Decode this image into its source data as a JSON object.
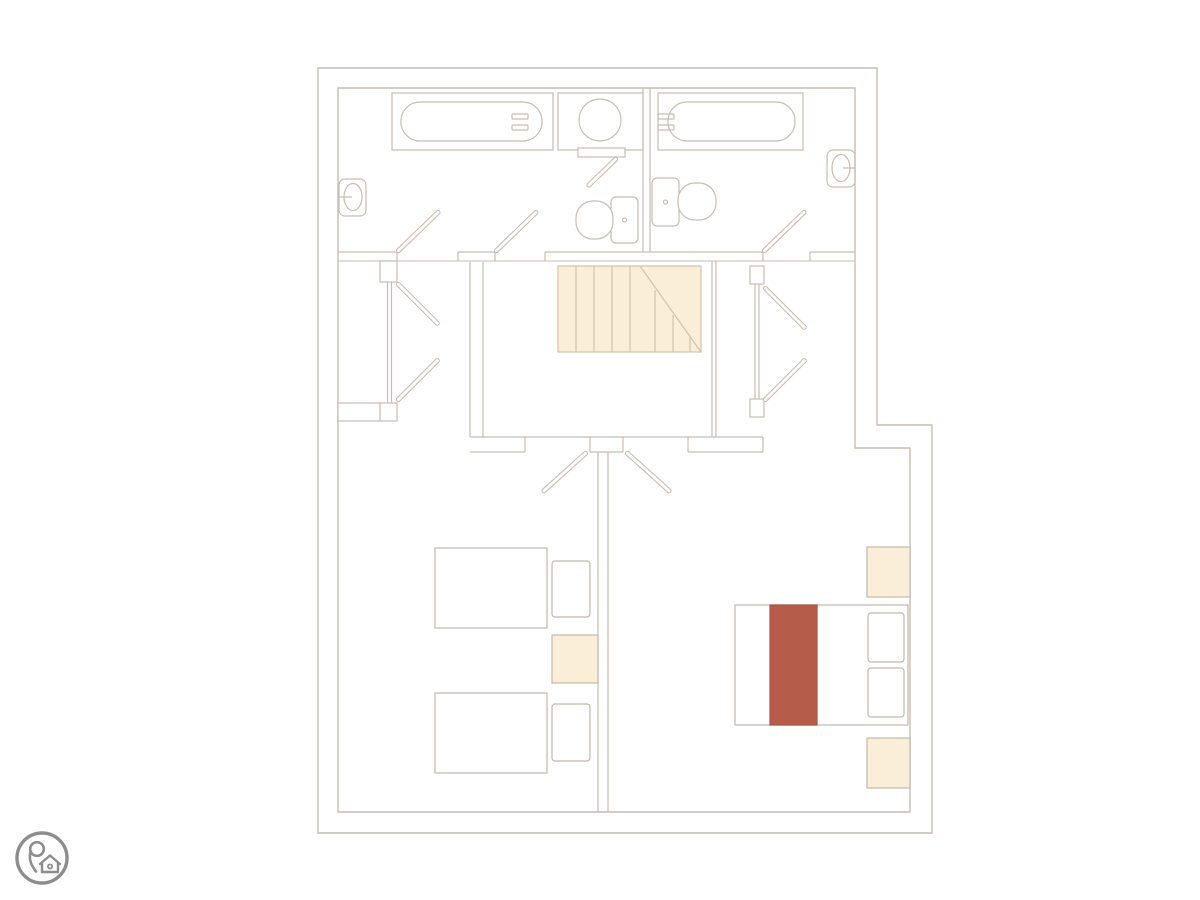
{
  "canvas": {
    "width": 1200,
    "height": 900,
    "background": "#ffffff"
  },
  "palette": {
    "wall_line": "#c9bcb2",
    "soft_line": "#d3c8be",
    "furniture_line": "#c3b7ab",
    "stairs_fill": "#fbeed7",
    "stairs_border": "#d2c3ae",
    "nightstand_fill": "#fbeed8",
    "runner_fill": "#b65c4a",
    "runner_border": "#aa5242",
    "logo_gray": "#8d8d8d",
    "floor_fill": "#ffffff"
  },
  "floorplan": {
    "type": "residential-upper-floor",
    "rooms": [
      "bathroom-left",
      "bathroom-right",
      "stair-hallway",
      "closet-left",
      "closet-right",
      "twin-bedroom",
      "master-bedroom"
    ],
    "fixtures": [
      "bathtub-left",
      "bathtub-right",
      "shower",
      "toilet-left",
      "toilet-right",
      "sink-left",
      "sink-right",
      "staircase",
      "twin-bed-1",
      "twin-bed-2",
      "double-bed",
      "bed-runner",
      "nightstand-twin",
      "nightstand-master-top",
      "nightstand-master-bottom",
      "door-swings"
    ]
  },
  "logo": {
    "icon": "map-pin-home-icon"
  }
}
